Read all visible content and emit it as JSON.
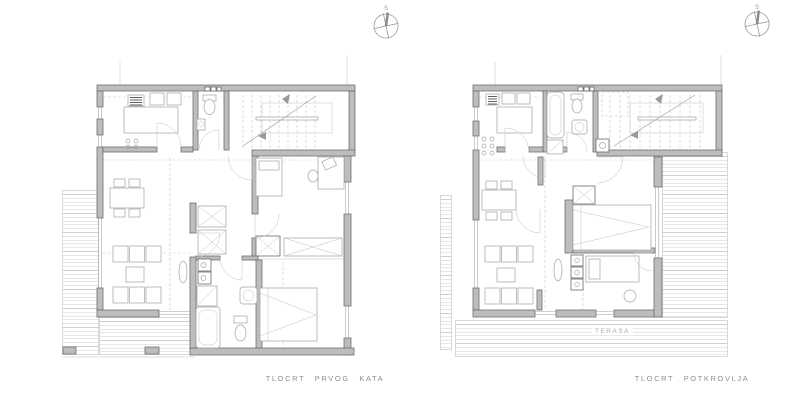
{
  "page": {
    "background": "#ffffff",
    "drawing_type": "architectural floor plans"
  },
  "plans": {
    "left": {
      "caption": "TLOCRT PRVOG KATA"
    },
    "right": {
      "caption": "TLOCRT POTKROVLJA",
      "terrace_label": "TERASA"
    }
  },
  "compass": {
    "north_label": "S"
  },
  "colors": {
    "wall_fill": "#bdbdbd",
    "wall_edge": "#6e6e6e",
    "furniture_line": "#a3a3a3",
    "dashed_line": "#c9c9c9",
    "deck_line": "#cfcfcf",
    "caption_text": "#8f8f8f",
    "appliance_dark": "#606060"
  }
}
